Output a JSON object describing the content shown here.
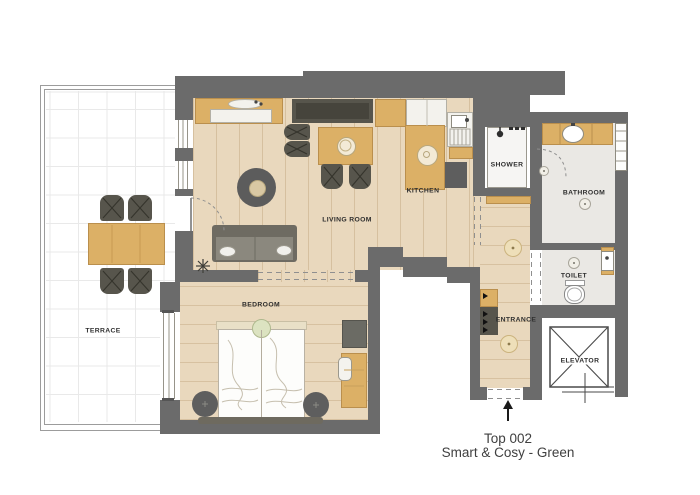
{
  "plan": {
    "caption": {
      "line1": "Top 002",
      "line2": "Smart & Cosy - Green"
    },
    "rooms": {
      "terrace": "TERRACE",
      "living_room": "LIVING ROOM",
      "kitchen": "KITCHEN",
      "shower": "SHOWER",
      "bathroom": "BATHROOM",
      "toilet": "TOILET",
      "entrance": "ENTRANCE",
      "elevator": "ELEVATOR",
      "bedroom": "BEDROOM"
    },
    "colors": {
      "wall": "#6b6b6b",
      "wood_floor": "#e9d8bd",
      "wood_furniture": "#dcb066",
      "dark_furniture": "#57554c",
      "tile_floor": "#eae8e4",
      "label_text": "#2e2e2e",
      "caption_text": "#3f3f3f",
      "bed_green_accent": "#dce3c1"
    }
  }
}
